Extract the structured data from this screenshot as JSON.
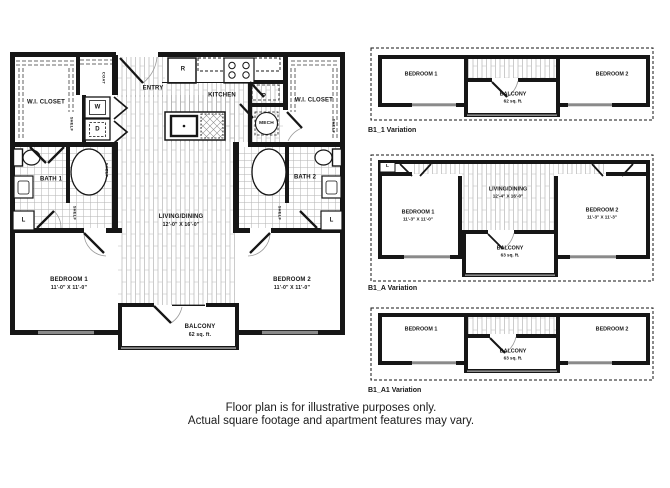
{
  "main_plan": {
    "wi_closet_left": "W.I. CLOSET",
    "wi_closet_right": "W.I. CLOSET",
    "coat": "COAT",
    "shelf": "SHELF",
    "washer": "W",
    "dryer": "D",
    "entry": "ENTRY",
    "kitchen": "KITCHEN",
    "fridge": "R",
    "pantry": "P",
    "mech": "MECH",
    "bath1": "BATH 1",
    "bath2": "BATH 2",
    "linen": "L",
    "living_name": "LIVING/DINING",
    "living_dims": "12'-0\" X 16'-0\"",
    "bedroom1_name": "BEDROOM 1",
    "bedroom1_dims": "11'-0\" X 11'-0\"",
    "bedroom2_name": "BEDROOM 2",
    "bedroom2_dims": "11'-0\" X 11'-0\"",
    "balcony_name": "BALCONY",
    "balcony_area": "62 sq. ft."
  },
  "variations": [
    {
      "label": "B1_1 Variation",
      "bedroom1": "BEDROOM 1",
      "bedroom2": "BEDROOM 2",
      "balcony_name": "BALCONY",
      "balcony_area": "62 sq. ft."
    },
    {
      "label": "B1_A Variation",
      "linen": "L",
      "bedroom1": "BEDROOM 1",
      "bedroom1_dims": "11'-3\" X 11'-0\"",
      "living_name": "LIVING/DINING",
      "living_dims": "12'-4\" X 16'-0\"",
      "bedroom2": "BEDROOM 2",
      "bedroom2_dims": "11'-3\" X 11'-3\"",
      "balcony_name": "BALCONY",
      "balcony_area": "63 sq. ft."
    },
    {
      "label": "B1_A1 Variation",
      "bedroom1": "BEDROOM 1",
      "bedroom2": "BEDROOM 2",
      "balcony_name": "BALCONY",
      "balcony_area": "63 sq. ft."
    }
  ],
  "disclaimer": {
    "line1": "Floor plan is for illustrative purposes only.",
    "line2": "Actual square footage and apartment features may vary."
  }
}
